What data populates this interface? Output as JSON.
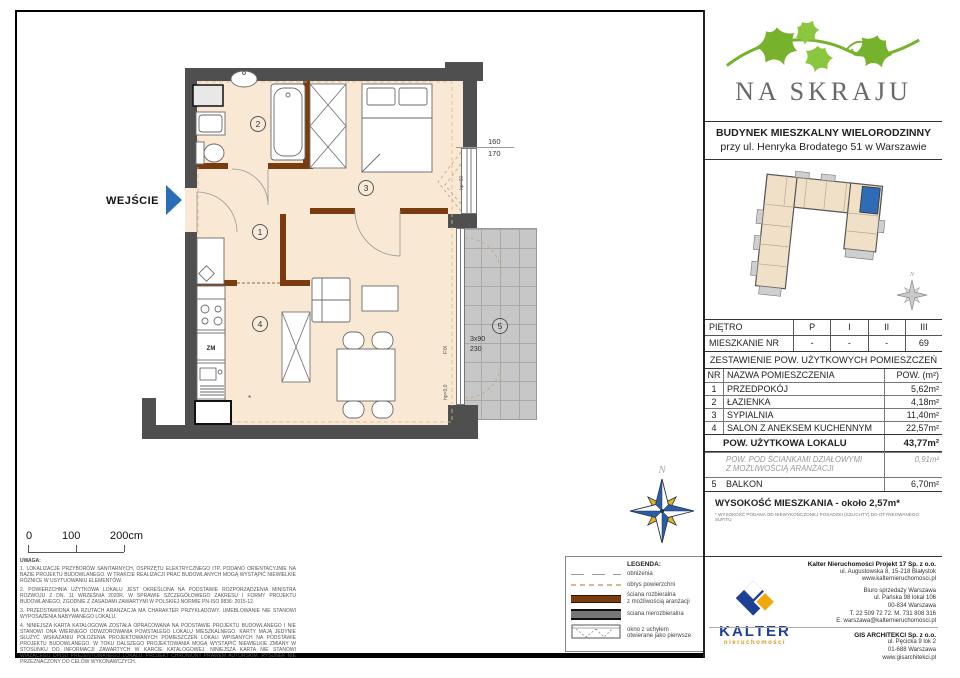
{
  "branding": {
    "project_name": "NA SKRAJU",
    "building_type": "BUDYNEK MIESZKALNY WIELORODZINNY",
    "building_address": "przy ul. Henryka Brodatego 51 w Warszawie"
  },
  "plan": {
    "entrance_label": "WEJŚCIE",
    "rooms": {
      "r1": "1",
      "r2": "2",
      "r3": "3",
      "r4": "4",
      "r5": "5"
    },
    "window_dim_top": "160",
    "window_dim_bottom": "170",
    "balcony_dim_line1": "3x90",
    "balcony_dim_line2": "230",
    "fix_label": "FIX",
    "hp_floor_label": "hp=0,0",
    "hp_window_label": "hp=60",
    "kitchen_zm_label": "ZM",
    "partition_mark": "*",
    "north_label": "N"
  },
  "locator": {
    "north_label": "N"
  },
  "scale_bar": {
    "tick0": "0",
    "tick100": "100",
    "tick200": "200cm"
  },
  "floor_table": {
    "row_floor": [
      "PIĘTRO",
      "P",
      "I",
      "II",
      "III"
    ],
    "row_unit": [
      "MIESZKANIE NR",
      "-",
      "-",
      "-",
      "69"
    ]
  },
  "area_table": {
    "title": "ZESTAWIENIE POW. UŻYTKOWYCH POMIESZCZEŃ",
    "col_nr": "NR",
    "col_name": "NAZWA POMIESZCZENIA",
    "col_area": "POW. (m²)",
    "rows": [
      {
        "nr": "1",
        "name": "PRZEDPOKÓJ",
        "area": "5,62m²"
      },
      {
        "nr": "2",
        "name": "ŁAZIENKA",
        "area": "4,18m²"
      },
      {
        "nr": "3",
        "name": "SYPIALNIA",
        "area": "11,40m²"
      },
      {
        "nr": "4",
        "name": "SALON Z ANEKSEM KUCHENNYM",
        "area": "22,57m²"
      }
    ],
    "total_label": "POW. UŻYTKOWA LOKALU",
    "total_value": "43,77m²",
    "partition_label": "POW. POD ŚCIANKAMI DZIAŁOWYMI\nZ MOŻLIWOŚCIĄ ARANŻACJI",
    "partition_value": "0,91m²",
    "balcony_nr": "5",
    "balcony_name": "BALKON",
    "balcony_value": "6,70m²",
    "height_label": "WYSOKOŚĆ MIESZKANIA - około 2,57m*",
    "height_footnote": "* WYSOKOŚĆ PODANA OD NIEWYKOŃCZONEJ POSADZKI (SZLICHTY) DO OTYNKOWANEGO SUFITU"
  },
  "legend": {
    "title": "LEGENDA:",
    "items": [
      {
        "label": "obniżenia"
      },
      {
        "label": "obrys powierzchni"
      },
      {
        "label": "ściana rozbieralna\nz możliwością aranżacji"
      },
      {
        "label": "ściana nierozbieralna"
      },
      {
        "label": "okno z uchyłem\notwierane jako pierwsze"
      }
    ]
  },
  "notes": {
    "title": "UWAGA:",
    "items": [
      "1. LOKALIZACJE PRZYBORÓW SANITARNYCH, OSPRZĘTU ELEKTRYCZNEGO ITP. PODANO ORIENTACYJNIE NA BAZIE PROJEKTU BUDOWLANEGO. W TRAKCIE REALIZACJI PRAC BUDOWLANYCH MOGĄ WYSTĄPIĆ NIEWIELKIE RÓŻNICE W USYTUOWANIU ELEMENTÓW.",
      "2. POWIERZCHNIA UŻYTKOWA LOKALU JEST OKREŚLONA NA PODSTAWIE ROZPORZĄDZENIA MINISTRA ROZWOJU Z DN. 11 WRZEŚNIA 2020R. W SPRAWIE SZCZEGÓŁOWEGO ZAKRESU I FORMY PROJEKTU BUDOWLANEGO, ZGODNIE Z ZASADAMI ZAWARTYMI W POLSKIEJ NORMIE PN-ISO 9836: 2015-12.",
      "3. PRZEDSTAWIONA NA RZUTACH ARANŻACJA MA CHARAKTER PRZYKŁADOWY. UMEBLOWANIE NIE STANOWI WYPOSAŻENIA NABYWANEGO LOKALU.",
      "4. NINIEJSZA KARTA KATALOGOWA ZOSTAŁA OPRACOWANA NA PODSTAWIE PROJEKTU BUDOWLANEGO I NIE STANOWI ONA WIERNEGO ODWZOROWANIA POWSTAŁEGO LOKALU MIESZKALNEGO. KARTY MAJĄ JEDYNIE SŁUŻYĆ WSKAZANIU POŁOŻENIA PROJEKTOWANYCH POMIESZCZEŃ LOKALI WPISANYCH NA PODSTAWIE PROJEKTU BUDOWLANEGO. W TOKU DALSZEGO PROJEKTOWANIA MOGĄ WYSTĄPIĆ NIEWIELKIE ZMIANY W STOSUNKU DO INFORMACJI ZAWARTYCH W KARCIE KATALOGOWEJ. NINIEJSZA KARTA NIE STANOWI WIĄŻĄCEGO OPISU PREZENTOWANEGO LOKALU. PROJEKT CHRONIONY PRAWEM AUTORSKIM. RYSUNEK NIE PRZEZNACZONY DO CELÓW WYKONAWCZYCH."
    ]
  },
  "footer": {
    "kalter_wordmark": "KALTER",
    "kalter_sub": "nieruchomości",
    "developer_name": "Kalter Nieruchomości Projekt 17 Sp. z o.o.",
    "developer_line1": "ul. Augustowska 8, 15-218 Białystok",
    "developer_line2": "www.kalternieruchomosci.pl",
    "office_line1": "Biuro sprzedaży Warszawa",
    "office_line2": "ul. Pańska 98 lokal 106",
    "office_line3": "00-834 Warszawa",
    "office_line4": "T. 22 509 72 72. M. 731 808 316",
    "office_line5": "E. warszawa@kalternieruchomosci.pl",
    "architect_name": "GIS ARCHITEKCI Sp. z o.o.",
    "architect_line1": "ul. Pęcicka 9 lok 2",
    "architect_line2": "01-688 Warszawa",
    "architect_line3": "www.gisarchitekci.pl"
  },
  "colors": {
    "accent_blue": "#2a6db8",
    "unit_highlight_blue": "#2e6cb5",
    "leaf_green": "#76b22c",
    "wall_gray": "#4f4f4f",
    "wall_brown": "#7a3c0f",
    "floor_beige": "#f8e8d4",
    "kalter_navy": "#1e3f96",
    "kalter_yellow": "#f2a70c"
  }
}
